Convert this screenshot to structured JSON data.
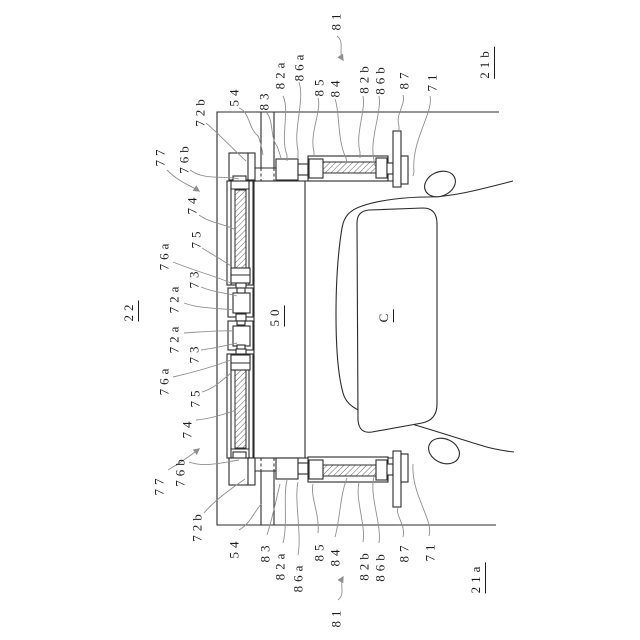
{
  "figure": {
    "kind": "patent line drawing",
    "description": "Rotated front view of a vehicle (C) beside boundary lines (21a, 21b) with a transfer frame (50) carrying screw actuators; reference numerals with wavy leader lines",
    "assembly_number": "22",
    "vehicle_label": "C",
    "colors": {
      "background": "#ffffff",
      "line": "#2b2b2b",
      "leader": "#8f8f8f",
      "text": "#1c1c1c"
    }
  },
  "labels": [
    {
      "id": "77-top",
      "text": "77",
      "x": 160,
      "y": 156,
      "underline": false
    },
    {
      "id": "76b-top",
      "text": "76b",
      "x": 184,
      "y": 158,
      "underline": false
    },
    {
      "id": "72b-top",
      "text": "72b",
      "x": 200,
      "y": 111,
      "underline": false
    },
    {
      "id": "54-top",
      "text": "54",
      "x": 234,
      "y": 96,
      "underline": false
    },
    {
      "id": "83-top",
      "text": "83",
      "x": 264,
      "y": 100,
      "underline": false
    },
    {
      "id": "82a-top",
      "text": "82a",
      "x": 280,
      "y": 74,
      "underline": false
    },
    {
      "id": "86a-top",
      "text": "86a",
      "x": 299,
      "y": 66,
      "underline": false
    },
    {
      "id": "85-top",
      "text": "85",
      "x": 319,
      "y": 86,
      "underline": false
    },
    {
      "id": "84-top",
      "text": "84",
      "x": 335,
      "y": 87,
      "underline": false
    },
    {
      "id": "81-top",
      "text": "81",
      "x": 336,
      "y": 20,
      "underline": false
    },
    {
      "id": "82b-top",
      "text": "82b",
      "x": 364,
      "y": 78,
      "underline": false
    },
    {
      "id": "86b-top",
      "text": "86b",
      "x": 380,
      "y": 79,
      "underline": false
    },
    {
      "id": "87-top",
      "text": "87",
      "x": 404,
      "y": 79,
      "underline": false
    },
    {
      "id": "71-top",
      "text": "71",
      "x": 432,
      "y": 81,
      "underline": false
    },
    {
      "id": "21b",
      "text": "21b",
      "x": 486,
      "y": 63,
      "underline": true
    },
    {
      "id": "22",
      "text": "22",
      "x": 130,
      "y": 311,
      "underline": true
    },
    {
      "id": "74-top",
      "text": "74",
      "x": 192,
      "y": 204,
      "underline": false
    },
    {
      "id": "75-top",
      "text": "75",
      "x": 196,
      "y": 238,
      "underline": false
    },
    {
      "id": "76a-top",
      "text": "76a",
      "x": 164,
      "y": 255,
      "underline": false
    },
    {
      "id": "73-top",
      "text": "73",
      "x": 194,
      "y": 278,
      "underline": false
    },
    {
      "id": "72a-top",
      "text": "72a",
      "x": 174,
      "y": 298,
      "underline": false
    },
    {
      "id": "72a-bottom",
      "text": "72a",
      "x": 174,
      "y": 338,
      "underline": false
    },
    {
      "id": "73-bottom",
      "text": "73",
      "x": 194,
      "y": 353,
      "underline": false
    },
    {
      "id": "76a-bottom",
      "text": "76a",
      "x": 164,
      "y": 380,
      "underline": false
    },
    {
      "id": "75-bottom",
      "text": "75",
      "x": 195,
      "y": 397,
      "underline": false
    },
    {
      "id": "74-bottom",
      "text": "74",
      "x": 187,
      "y": 428,
      "underline": false
    },
    {
      "id": "76b-bottom",
      "text": "76b",
      "x": 180,
      "y": 471,
      "underline": false
    },
    {
      "id": "77-bottom",
      "text": "77",
      "x": 159,
      "y": 485,
      "underline": false
    },
    {
      "id": "72b-bottom",
      "text": "72b",
      "x": 197,
      "y": 526,
      "underline": false
    },
    {
      "id": "54-bottom",
      "text": "54",
      "x": 234,
      "y": 548,
      "underline": false
    },
    {
      "id": "83-bottom",
      "text": "83",
      "x": 265,
      "y": 552,
      "underline": false
    },
    {
      "id": "82a-bottom",
      "text": "82a",
      "x": 280,
      "y": 565,
      "underline": false
    },
    {
      "id": "86a-bottom",
      "text": "86a",
      "x": 298,
      "y": 577,
      "underline": false
    },
    {
      "id": "85-bottom",
      "text": "85",
      "x": 319,
      "y": 551,
      "underline": false
    },
    {
      "id": "84-bottom",
      "text": "84",
      "x": 335,
      "y": 556,
      "underline": false
    },
    {
      "id": "81-bottom",
      "text": "81",
      "x": 336,
      "y": 617,
      "underline": false
    },
    {
      "id": "82b-bottom",
      "text": "82b",
      "x": 364,
      "y": 565,
      "underline": false
    },
    {
      "id": "86b-bottom",
      "text": "86b",
      "x": 380,
      "y": 566,
      "underline": false
    },
    {
      "id": "87-bottom",
      "text": "87",
      "x": 404,
      "y": 552,
      "underline": false
    },
    {
      "id": "71-bottom",
      "text": "71",
      "x": 430,
      "y": 551,
      "underline": false
    },
    {
      "id": "21a",
      "text": "21a",
      "x": 477,
      "y": 578,
      "underline": true
    },
    {
      "id": "50",
      "text": "50",
      "x": 276,
      "y": 316,
      "underline": true
    },
    {
      "id": "C",
      "text": "C",
      "x": 385,
      "y": 316,
      "underline": true
    }
  ]
}
